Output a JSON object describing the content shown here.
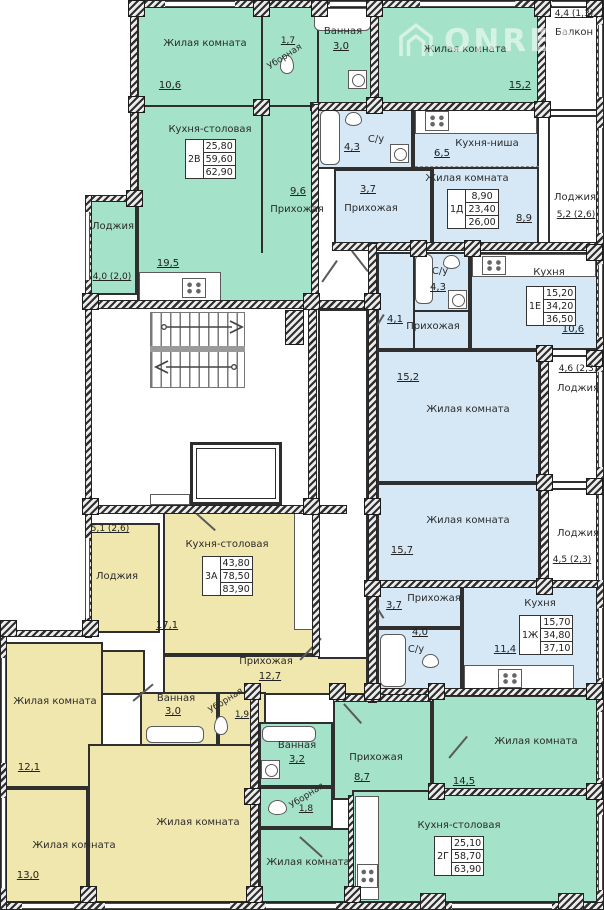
{
  "watermark": {
    "text": "ONREA",
    "logo": "house-logo"
  },
  "colors": {
    "apartment_green": "#a4e2c9",
    "apartment_blue": "#d6e8f6",
    "apartment_yellow": "#f0e7af",
    "walls": "#2f2f2f"
  },
  "apartments": [
    {
      "id": "2В",
      "values": [
        "25,80",
        "59,60",
        "62,90"
      ]
    },
    {
      "id": "1Д",
      "values": [
        "8,90",
        "23,40",
        "26,00"
      ]
    },
    {
      "id": "1Е",
      "values": [
        "15,20",
        "34,20",
        "36,50"
      ]
    },
    {
      "id": "1Ж",
      "values": [
        "15,70",
        "34,80",
        "37,10"
      ]
    },
    {
      "id": "3А",
      "values": [
        "43,80",
        "78,50",
        "83,90"
      ]
    },
    {
      "id": "2Г",
      "values": [
        "25,10",
        "58,70",
        "63,90"
      ]
    }
  ],
  "rooms": [
    {
      "label": "Жилая комната",
      "area": "10,6"
    },
    {
      "label": "Уборная",
      "area": "1,7"
    },
    {
      "label": "Ванная",
      "area": "3,0"
    },
    {
      "label": "Жилая комната",
      "area": "15,2"
    },
    {
      "label": "Балкон",
      "area": "4,4 (1,3)"
    },
    {
      "label": "Кухня-столовая",
      "area": "19,5"
    },
    {
      "label": "Прихожая",
      "area": "9,6"
    },
    {
      "label": "Лоджия",
      "area": "4,0 (2,0)"
    },
    {
      "label": "С/у",
      "area": "4,3"
    },
    {
      "label": "Прихожая",
      "area": "3,7"
    },
    {
      "label": "Кухня-ниша",
      "area": "6,5"
    },
    {
      "label": "Жилая комната",
      "area": "8,9"
    },
    {
      "label": "Лоджия",
      "area": "5,2 (2,6)"
    },
    {
      "label": "С/у",
      "area": "4,3"
    },
    {
      "label": "Прихожая",
      "area": "4,1"
    },
    {
      "label": "Кухня",
      "area": "10,6"
    },
    {
      "label": "Жилая комната",
      "area": "15,2"
    },
    {
      "label": "Лоджия",
      "area": "4,6 (2,3)"
    },
    {
      "label": "Жилая комната",
      "area": "15,7"
    },
    {
      "label": "Лоджия",
      "area": "4,5 (2,3)"
    },
    {
      "label": "Прихожая",
      "area": "3,7"
    },
    {
      "label": "С/у",
      "area": "4,0"
    },
    {
      "label": "Кухня",
      "area": "11,4"
    },
    {
      "label": "Лоджия",
      "area": "5,1 (2,6)"
    },
    {
      "label": "Кухня-столовая",
      "area": "17,1"
    },
    {
      "label": "Прихожая",
      "area": "12,7"
    },
    {
      "label": "Ванная",
      "area": "3,0"
    },
    {
      "label": "Уборная",
      "area": "1,9"
    },
    {
      "label": "Жилая комната",
      "area": "12,1"
    },
    {
      "label": "Жилая комната",
      "area": "13,0"
    },
    {
      "label": "Жилая комната",
      "area": ""
    },
    {
      "label": "Ванная",
      "area": "3,2"
    },
    {
      "label": "Уборная",
      "area": "1,8"
    },
    {
      "label": "Прихожая",
      "area": "8,7"
    },
    {
      "label": "Жилая комната",
      "area": "14,5"
    },
    {
      "label": "Кухня-столовая",
      "area": ""
    },
    {
      "label": "Жилая комната",
      "area": ""
    }
  ]
}
